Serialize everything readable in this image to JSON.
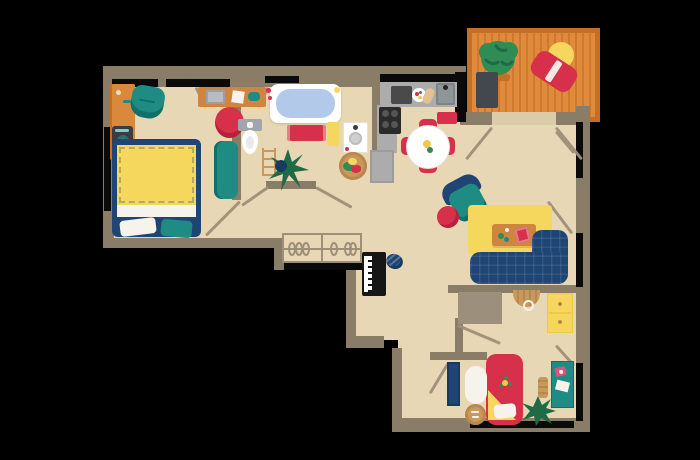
{
  "title": "apartment-floor-plan-illustration",
  "palette": {
    "bg": "#000000",
    "floor": "#E8D7B4",
    "floorLight": "#DACCA9",
    "wall": "#8A7D68",
    "line": "#9D9078",
    "dark": "#0A0A0A",
    "navy": "#1F4575",
    "navyDark": "#173A63",
    "teal": "#1E8C82",
    "tealDark": "#137068",
    "crimson": "#D6304B",
    "pink": "#E0507A",
    "yellow": "#F5D75E",
    "yellowDeep": "#EFC94C",
    "orange": "#D9893B",
    "balconyFill": "#E08A3C",
    "balconyStripe": "#CE7A2E",
    "balconyBorder": "#C46F28",
    "green": "#2F8C55",
    "greenDark": "#1E6B45",
    "counter": "#ACACAC",
    "counterDark": "#8F9496",
    "steel": "#4A4A4A",
    "white": "#FFFFFF",
    "paper": "#F5F3EC",
    "water": "#B3C9EA",
    "tan": "#C9985C",
    "tanDark": "#B8894C",
    "wood": "#CF8440",
    "grayMat": "#43484E",
    "closetGray": "#9C8F7B",
    "applianceGray": "#9FA6AE"
  },
  "rooms": [
    {
      "id": "bedroom-1",
      "furniture": [
        "wardrobe-washer-unit",
        "teal-armchair",
        "wall-desk",
        "laptop",
        "paper-sheet",
        "notebook",
        "desk-chair",
        "double-bed",
        "yellow-blanket",
        "pillows",
        "teal-bench"
      ]
    },
    {
      "id": "bathroom",
      "furniture": [
        "bathtub",
        "bath-mat",
        "towel",
        "toilet",
        "ladder-rack",
        "potted-plant",
        "sink-unit",
        "laundry-basket"
      ]
    },
    {
      "id": "kitchen",
      "furniture": [
        "counter",
        "cutting-board",
        "plate",
        "baguette",
        "kitchen-sink",
        "stove",
        "lower-counter",
        "door-mat",
        "dining-table",
        "dining-chairs"
      ]
    },
    {
      "id": "balcony",
      "furniture": [
        "bush-planter",
        "outdoor-mat",
        "round-table",
        "lounge-chair"
      ]
    },
    {
      "id": "living-room",
      "furniture": [
        "armchair",
        "pouf",
        "rug",
        "coffee-table",
        "book",
        "sectional-sofa"
      ]
    },
    {
      "id": "hallway",
      "furniture": [
        "open-closet-hangers",
        "upright-piano",
        "piano-stool"
      ]
    },
    {
      "id": "bedroom-2",
      "furniture": [
        "built-in-closet",
        "woven-basket",
        "yellow-sideboard",
        "single-bed",
        "blanket-triangle",
        "pillow",
        "bookshelf",
        "white-rug",
        "basket-stool",
        "splat-rug",
        "desk",
        "wooden-chair"
      ]
    }
  ],
  "notes": {
    "text_visible": "none",
    "view": "top-down floor plan"
  }
}
